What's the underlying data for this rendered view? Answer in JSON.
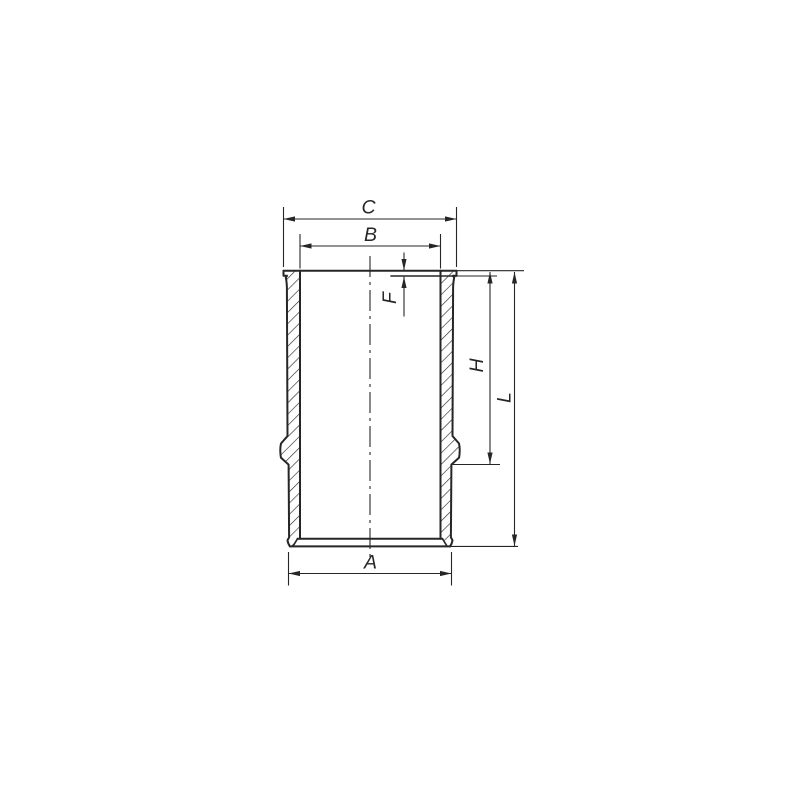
{
  "drawing": {
    "background_color": "#ffffff",
    "line_color": "#262626",
    "dimension_labels": {
      "c": "C",
      "b": "B",
      "f": "F",
      "h": "H",
      "l": "L",
      "a": "A"
    }
  }
}
